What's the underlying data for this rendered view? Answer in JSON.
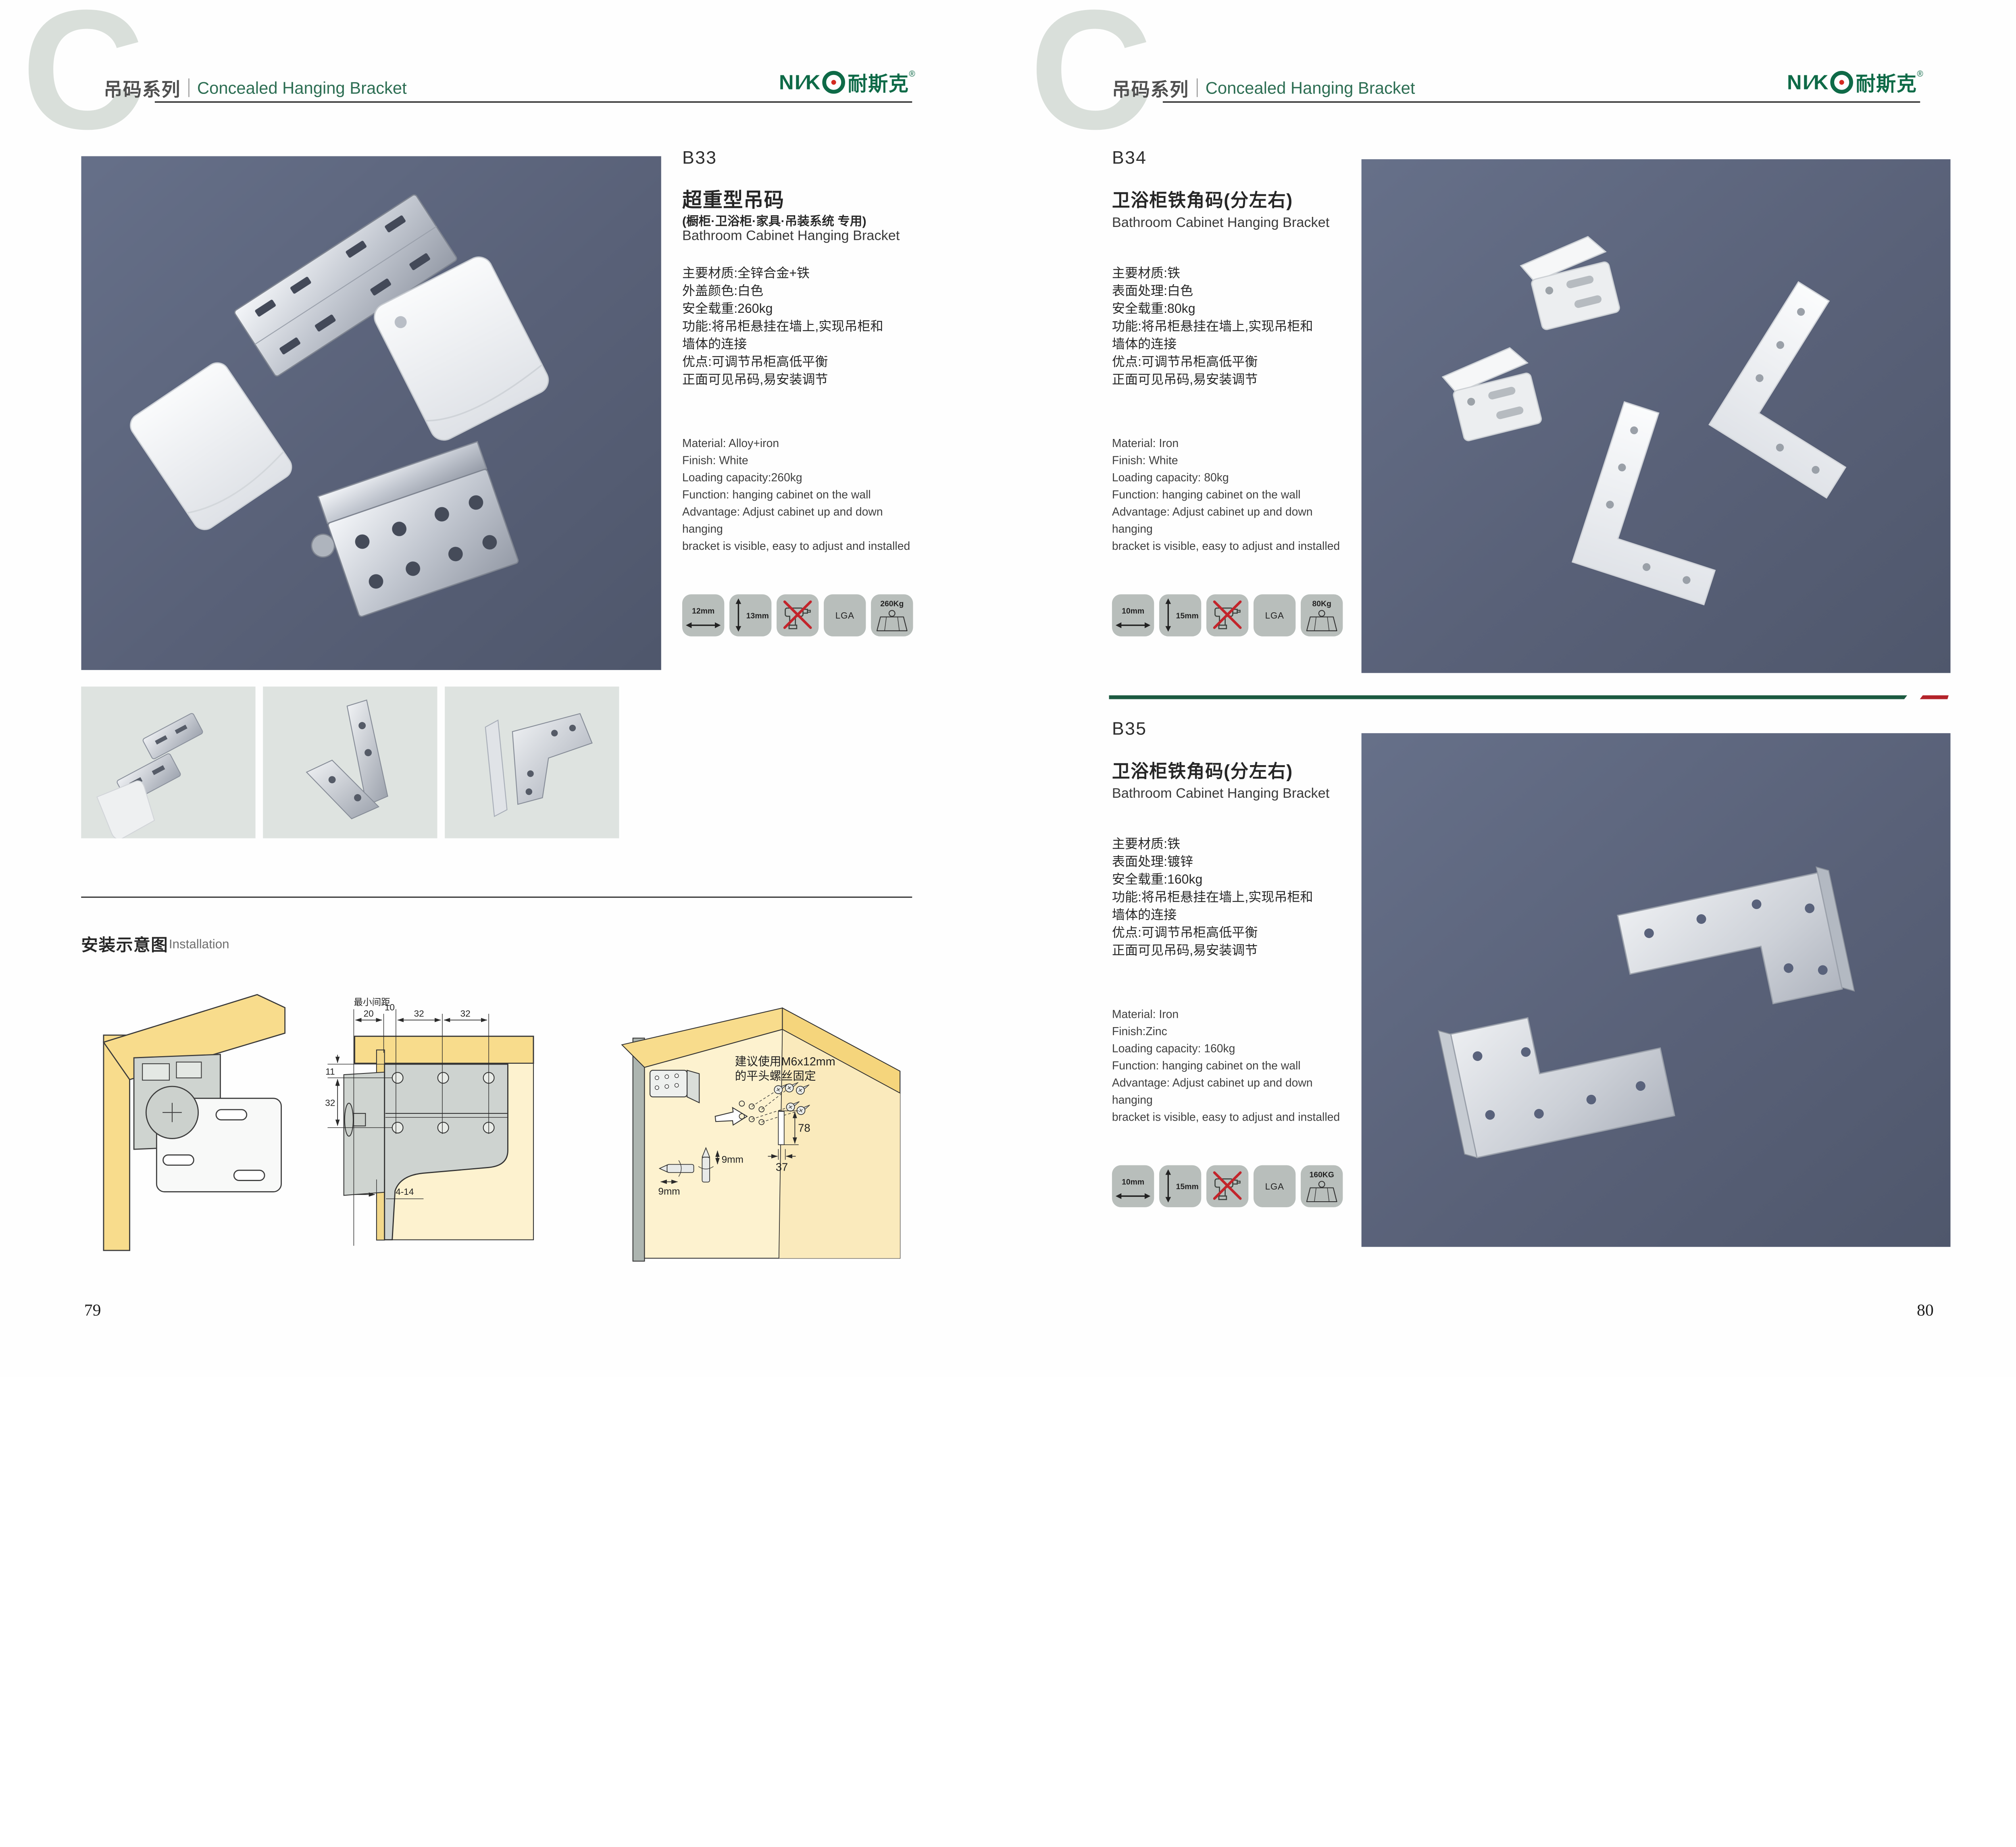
{
  "header": {
    "watermark": "C",
    "series_cn": "吊码系列",
    "series_en": "Concealed Hanging Bracket"
  },
  "brand": {
    "logo_en": "NI∕K",
    "logo_cn": "耐斯克",
    "registered": "®"
  },
  "colors": {
    "accent_green": "#1c5a41",
    "logo_green": "#0e6a47",
    "accent_red": "#b4232a",
    "photo_background": "#5b6279",
    "icon_tile_background": "#b8bebb",
    "thumbnail_background": "#dee3e0"
  },
  "products": [
    {
      "code": "B33",
      "title_cn": "超重型吊码",
      "subtitle_cn": "(橱柜·卫浴柜·家具·吊装系统 专用)",
      "title_en": "Bathroom Cabinet Hanging Bracket",
      "specs_cn": [
        "主要材质:全锌合金+铁",
        "外盖颜色:白色",
        "安全载重:260kg",
        "功能:将吊柜悬挂在墙上,实现吊柜和",
        "墙体的连接",
        "优点:可调节吊柜高低平衡",
        "正面可见吊码,易安装调节"
      ],
      "specs_en": [
        "Material: Alloy+iron",
        "Finish: White",
        "Loading capacity:260kg",
        "Function: hanging cabinet on the wall",
        "Advantage: Adjust cabinet up and down hanging",
        "bracket is visible, easy to adjust and installed"
      ],
      "icons": {
        "width": "12mm",
        "height": "13mm",
        "no_drill": "no-drill",
        "cert": "LGA",
        "load": "260Kg"
      }
    },
    {
      "code": "B34",
      "title_cn": "卫浴柜铁角码(分左右)",
      "title_en": "Bathroom Cabinet Hanging Bracket",
      "specs_cn": [
        "主要材质:铁",
        "表面处理:白色",
        "安全载重:80kg",
        "功能:将吊柜悬挂在墙上,实现吊柜和",
        "墙体的连接",
        "优点:可调节吊柜高低平衡",
        "正面可见吊码,易安装调节"
      ],
      "specs_en": [
        "Material: Iron",
        "Finish: White",
        "Loading capacity: 80kg",
        "Function: hanging cabinet on the wall",
        "Advantage: Adjust cabinet up and down hanging",
        "bracket is visible, easy to adjust and installed"
      ],
      "icons": {
        "width": "10mm",
        "height": "15mm",
        "no_drill": "no-drill",
        "cert": "LGA",
        "load": "80Kg"
      }
    },
    {
      "code": "B35",
      "title_cn": "卫浴柜铁角码(分左右)",
      "title_en": "Bathroom Cabinet Hanging Bracket",
      "specs_cn": [
        "主要材质:铁",
        "表面处理:镀锌",
        "安全载重:160kg",
        "功能:将吊柜悬挂在墙上,实现吊柜和",
        "墙体的连接",
        "优点:可调节吊柜高低平衡",
        "正面可见吊码,易安装调节"
      ],
      "specs_en": [
        "Material: Iron",
        "Finish:Zinc",
        "Loading capacity: 160kg",
        "Function: hanging cabinet on the wall",
        "Advantage: Adjust cabinet up and down hanging",
        "bracket is visible, easy to adjust and installed"
      ],
      "icons": {
        "width": "10mm",
        "height": "15mm",
        "no_drill": "no-drill",
        "cert": "LGA",
        "load": "160KG"
      }
    }
  ],
  "installation": {
    "heading_cn": "安装示意图",
    "heading_en": "Installation",
    "diagram2": {
      "min_gap": "最小间距",
      "d20": "20",
      "d10": "10",
      "d32a": "32",
      "d32b": "32",
      "d11": "11",
      "d32c": "32",
      "d4_14": "4-14"
    },
    "diagram3": {
      "note_line1": "建议使用M6x12mm",
      "note_line2": "的平头螺丝固定",
      "d78": "78",
      "d37": "37",
      "d9a": "9mm",
      "d9b": "9mm"
    }
  },
  "pages": {
    "left": "79",
    "right": "80"
  }
}
